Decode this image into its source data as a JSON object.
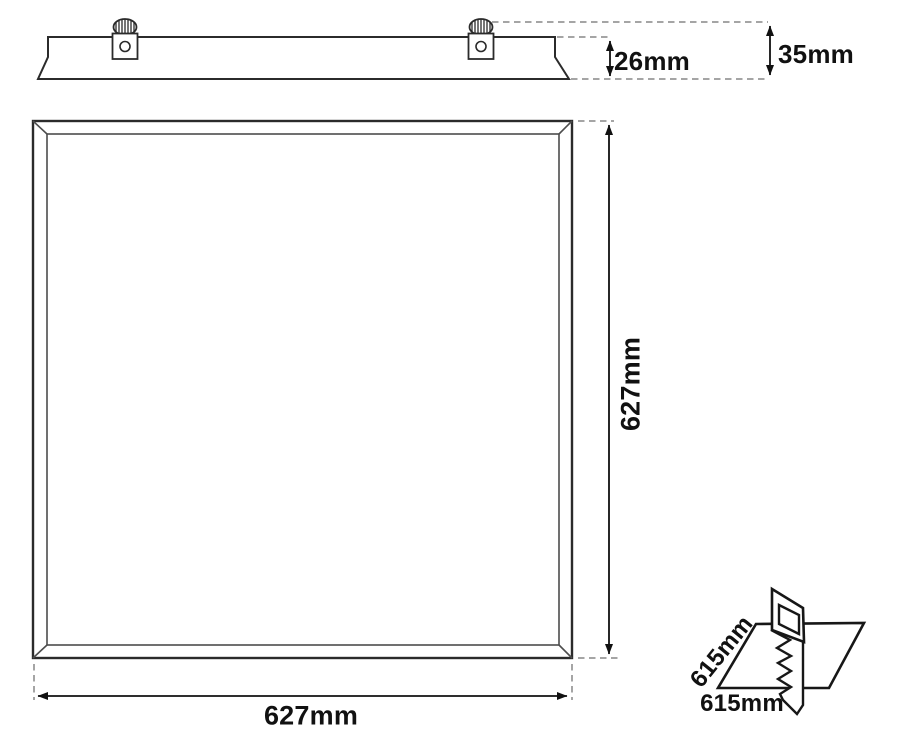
{
  "colors": {
    "outline": "#2b2b2b",
    "bevel": "#4d4d4d",
    "dashed": "#a5a5a5",
    "dimension": "#111111",
    "inset_outline": "#171717",
    "background": "#ffffff"
  },
  "side_view": {
    "recess_depth_label": "26mm",
    "overall_depth_label": "35mm"
  },
  "front_view": {
    "height_label": "627mm",
    "width_label": "627mm"
  },
  "cutout_view": {
    "side_label": "615mm",
    "bottom_label": "615mm"
  }
}
